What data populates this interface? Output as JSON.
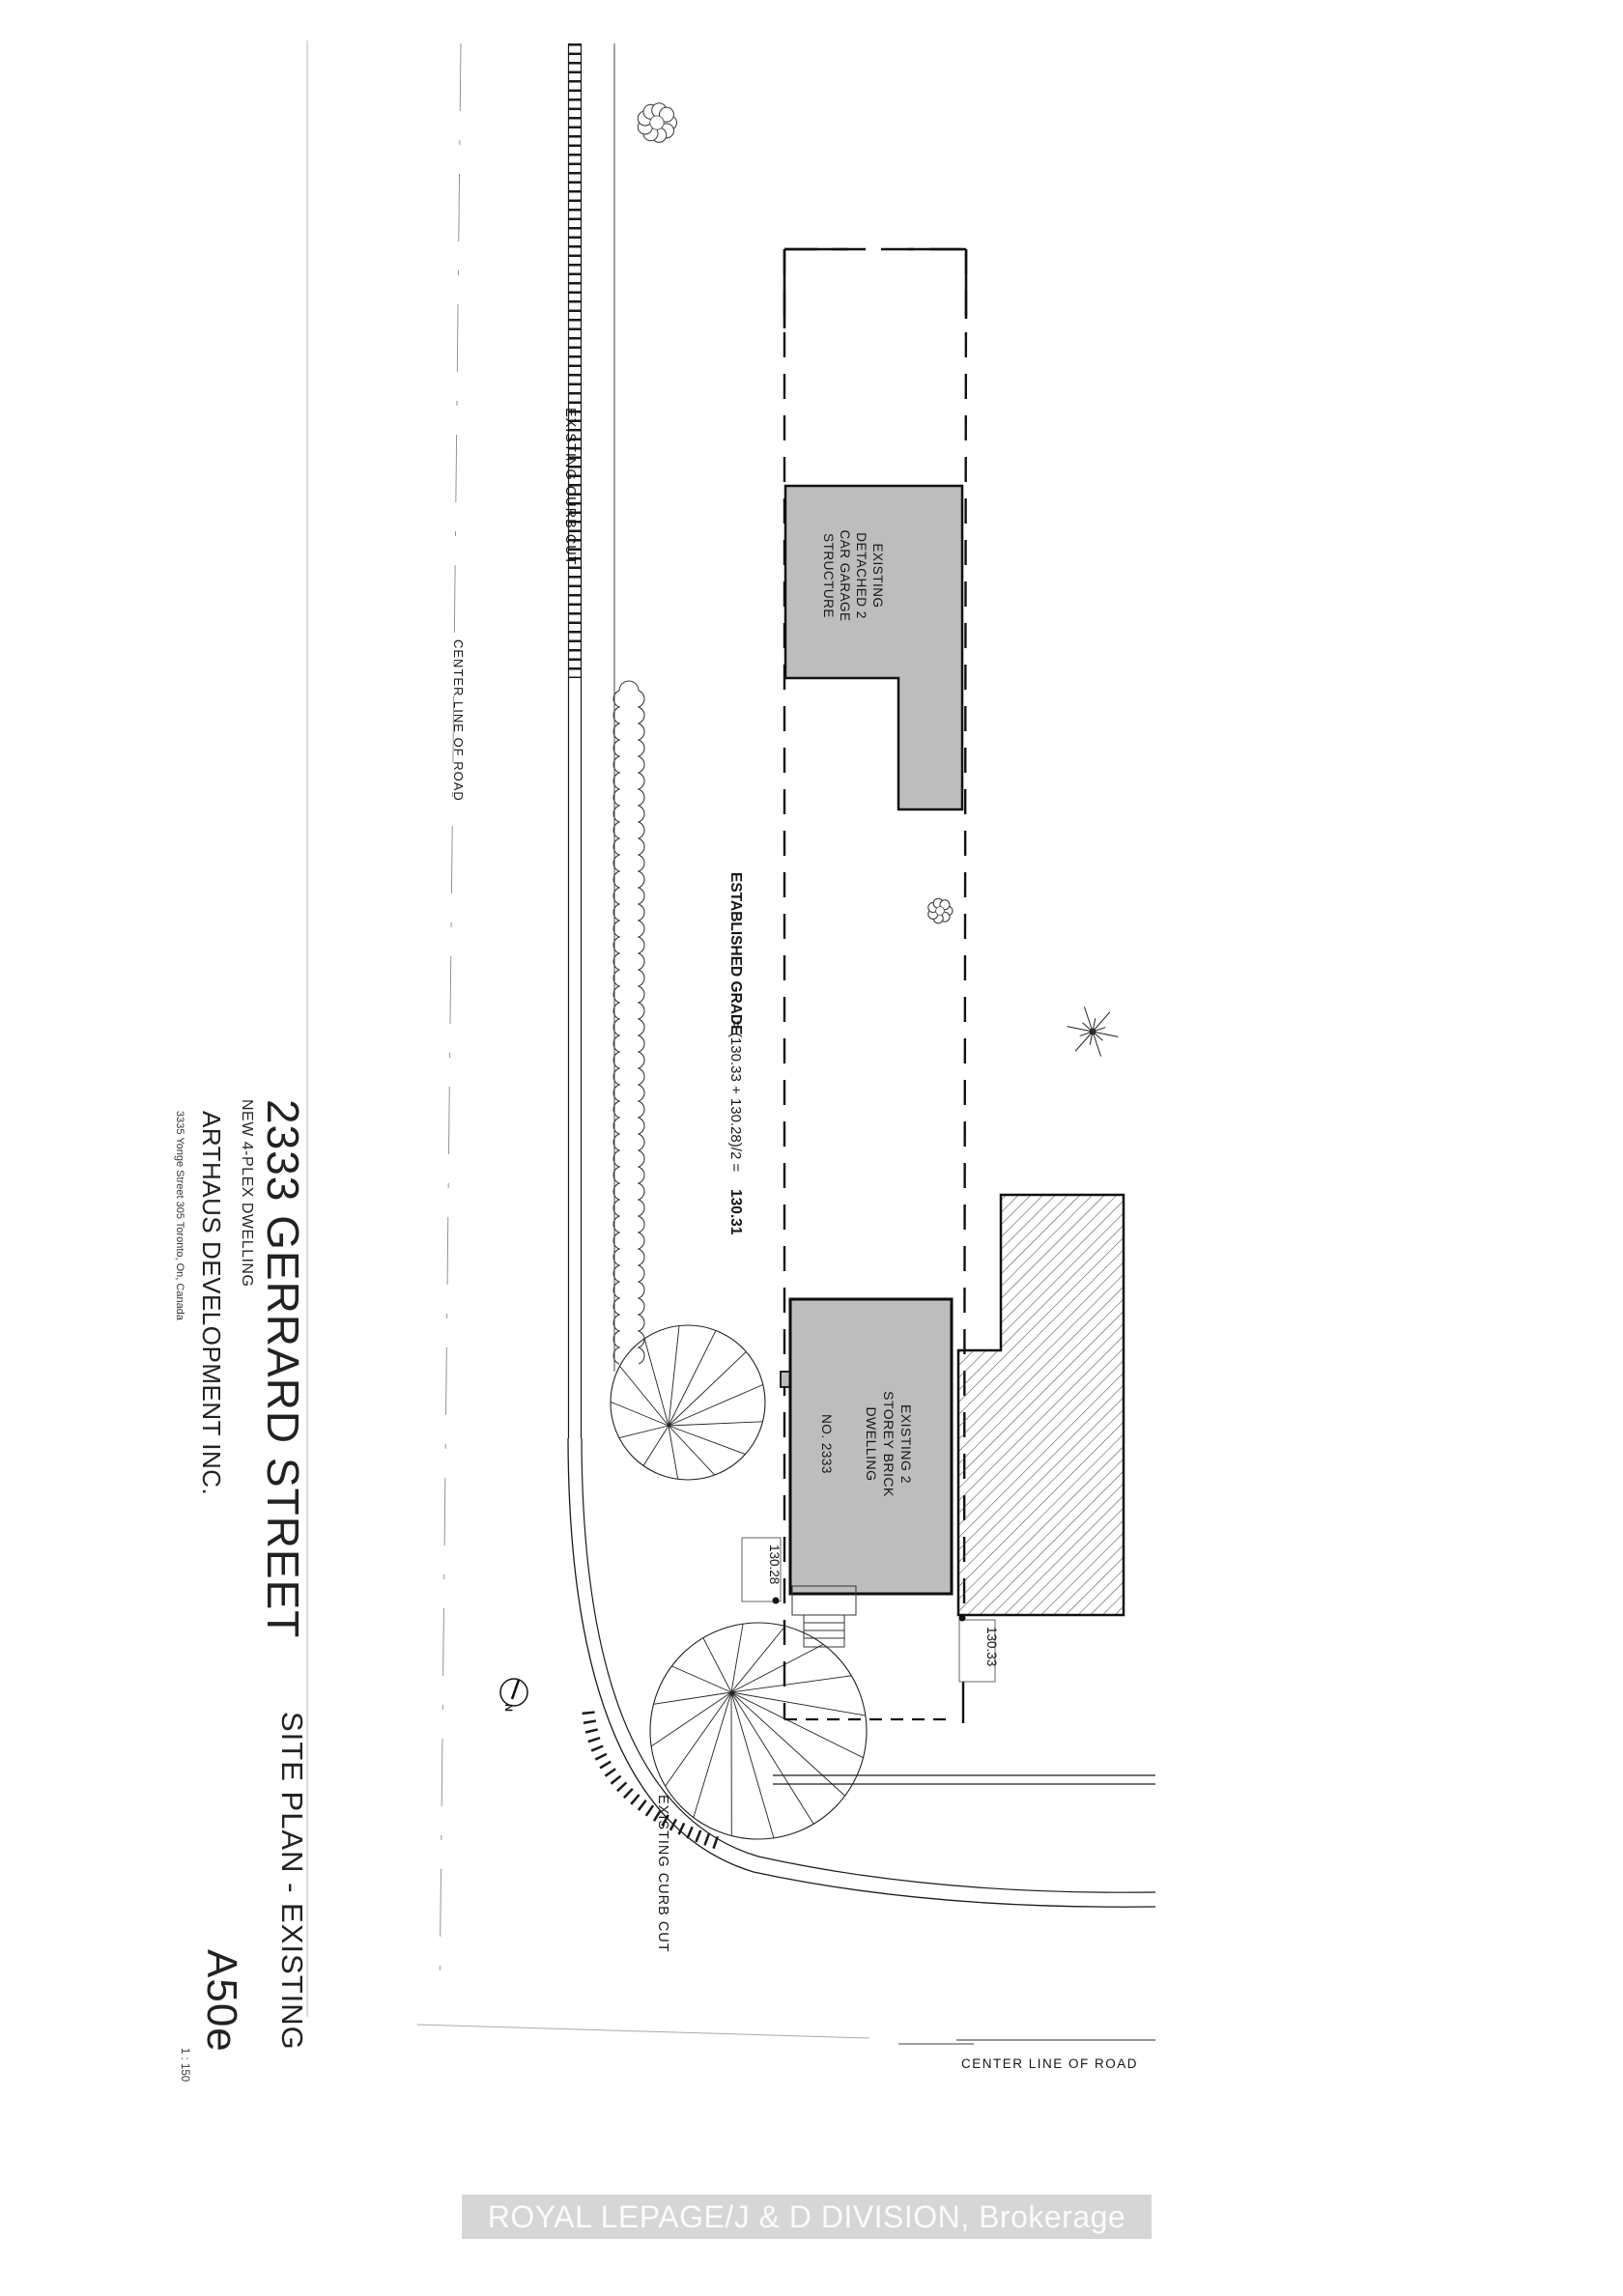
{
  "title_block": {
    "address": "2333 GERRARD STREET",
    "project": "NEW 4-PLEX DWELLING",
    "company": "ARTHAUS DEVELOPMENT INC.",
    "company_address": "3335 Yonge Street 305 Toronto, On, Canada",
    "sheet_title": "SITE PLAN - EXISTING",
    "sheet_number": "A50e",
    "scale": "1 : 150"
  },
  "plan": {
    "labels": {
      "curb_cut_left": "EXISTING CURB CUT",
      "curb_cut_corner": "EXISTING CURB CUT",
      "center_line_left": "CENTER LINE OF ROAD",
      "center_line_bottom": "CENTER LINE OF ROAD",
      "north": "N"
    },
    "grade": {
      "label": "ESTABLISHED GRADE",
      "formula": "= (130.33 + 130.28)/2 =",
      "value": "130.31"
    },
    "garage": {
      "lines": [
        "EXISTING",
        "DETACHED 2",
        "CAR GARAGE",
        "STRUCTURE"
      ]
    },
    "dwelling": {
      "lines": [
        "EXISTING 2",
        "STOREY BRICK",
        "DWELLING"
      ],
      "number": "NO. 2333"
    },
    "grades": {
      "front_left": "130.28",
      "front_right": "130.33"
    }
  },
  "watermark": "ROYAL LEPAGE/J & D DIVISION, Brokerage",
  "colors": {
    "building_fill": "#bdbdbd",
    "hatch_stroke": "#4a4a4a",
    "ink": "#1a1a1a",
    "watermark_band": "#d6d6d6",
    "watermark_text": "#fbfbfb"
  }
}
